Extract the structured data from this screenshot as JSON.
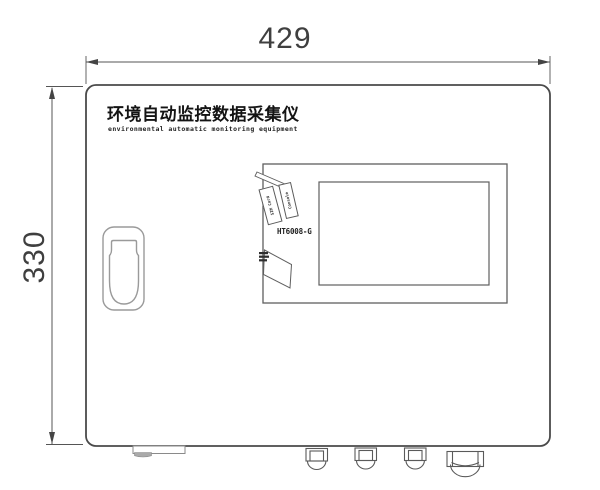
{
  "drawing": {
    "type": "technical-dimension-drawing",
    "dimensions": {
      "width_label": "429",
      "height_label": "330"
    },
    "device": {
      "title_cn": "环境自动监控数据采集仪",
      "title_en": "environmental automatic monitoring equipment",
      "model": "HT6008-G",
      "port_labels": {
        "sim": "SIM Card",
        "console": "Console"
      }
    },
    "colors": {
      "outline": "#4a4a4a",
      "secondary_line": "#9a9a9a",
      "dimension_line": "#555555",
      "text": "#1f1f1f",
      "tab_fill": "#aaaaaa",
      "background": "#ffffff"
    }
  }
}
